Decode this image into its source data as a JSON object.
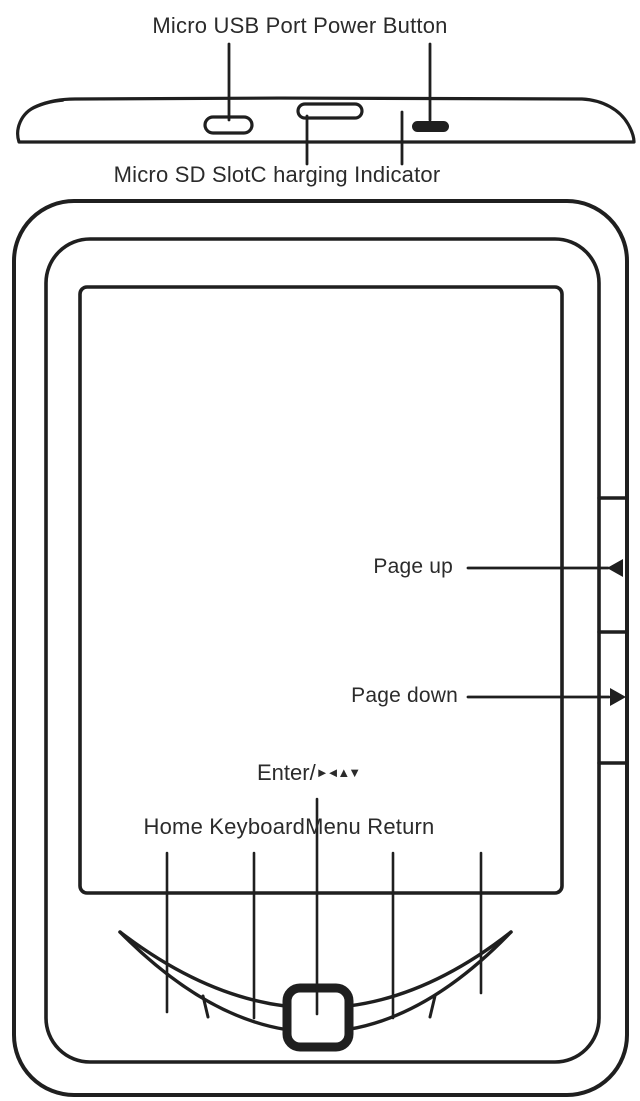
{
  "diagram": {
    "device": "e-reader-part-diagram",
    "colors": {
      "line": "#1f1f1f",
      "text": "#2b2b2b",
      "background": "#ffffff"
    },
    "top_view": {
      "top_label": "Micro USB Port Power Button",
      "bottom_label": "Micro SD SlotC harging Indicator",
      "parts": [
        "Micro USB Port",
        "Power Button",
        "Micro SD Slot",
        "Charging Indicator"
      ]
    },
    "front_view": {
      "page_up_label": "Page up",
      "page_down_label": "Page down",
      "enter_label": "Enter/",
      "enter_symbols": "►◄▲▼",
      "bottom_row_label": "Home KeyboardMenu Return",
      "bottom_buttons": [
        "Home",
        "Keyboard",
        "Menu",
        "Return"
      ]
    }
  }
}
